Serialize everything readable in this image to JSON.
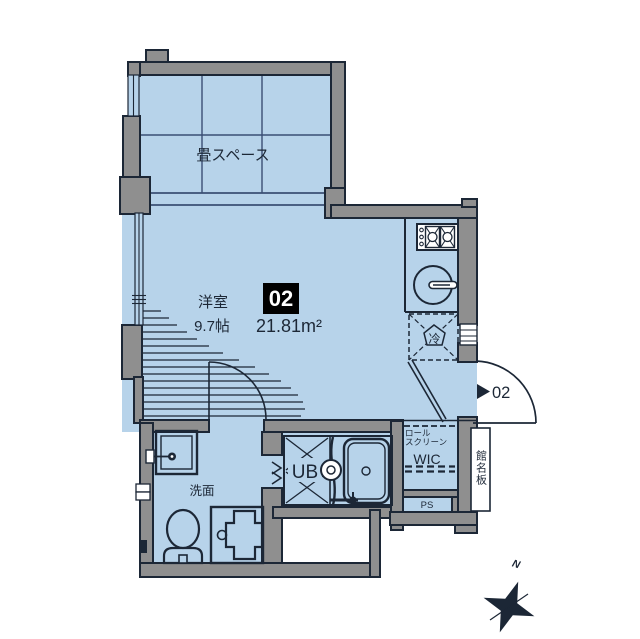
{
  "colors": {
    "floor": "#b7d3ea",
    "wall": "#8f8f8f",
    "line": "#1c2736",
    "paper": "#ffffff",
    "badge_bg": "#000000",
    "badge_text": "#ffffff",
    "grid": "#3a4f74"
  },
  "plan": {
    "tatami_label": "畳スペース",
    "room_label": "洋室",
    "room_size": "9.7帖",
    "unit_number": "02",
    "unit_area": "21.81m²",
    "fridge_label": "冷",
    "entrance_unit": "02",
    "roll_screen_line1": "ロール",
    "roll_screen_line2": "スクリーン",
    "wic_label": "WIC",
    "nameplate_label": "館名板",
    "ps_label": "PS",
    "washroom_label": "洗面",
    "bath_label": "UB",
    "compass_north": "N"
  }
}
